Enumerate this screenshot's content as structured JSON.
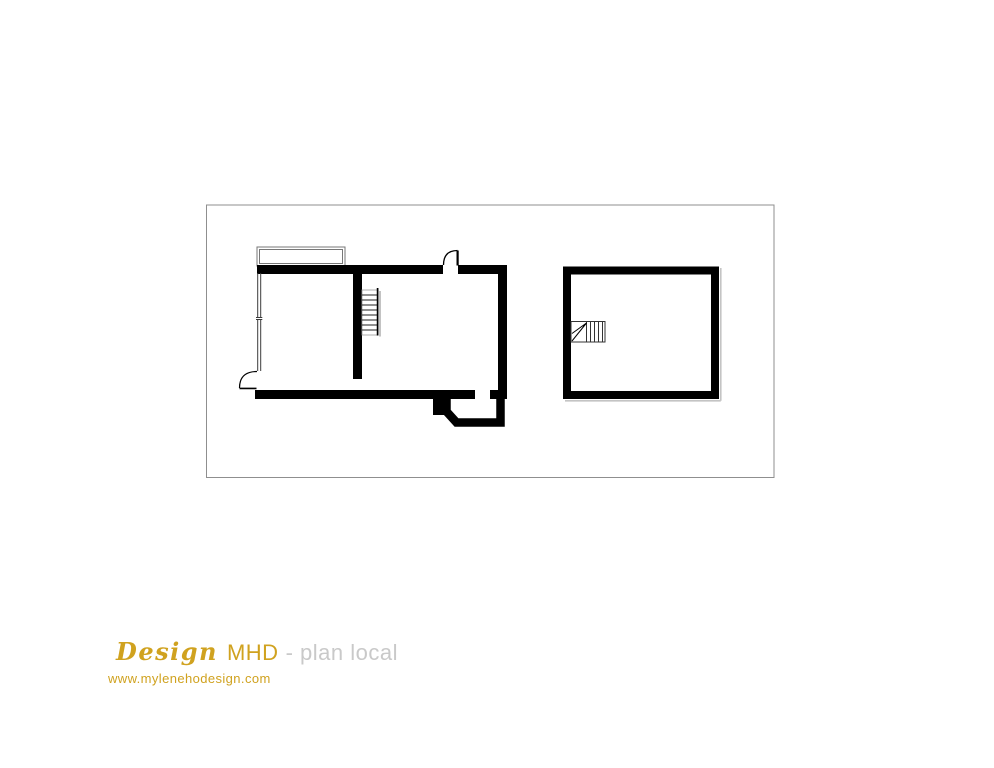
{
  "branding": {
    "script": "Design",
    "name": "MHD",
    "suffix": "- plan local",
    "website": "www.mylenehodesign.com",
    "gold_color": "#d0a21f",
    "gray_color": "#c9c9c9"
  },
  "plan": {
    "ink_color": "#000000",
    "frame_color": "#8f8f8f",
    "shadow_color": "#c4c4c4",
    "veranda_line_color": "#777777",
    "icons": {
      "door_swing": "quarter-arc-door-symbol",
      "straight_stair": "stair-treads-symbol",
      "winder_stair": "winder-stair-symbol",
      "glazed_wall": "double-line-window-wall",
      "veranda": "thin-double-line-bay"
    }
  }
}
